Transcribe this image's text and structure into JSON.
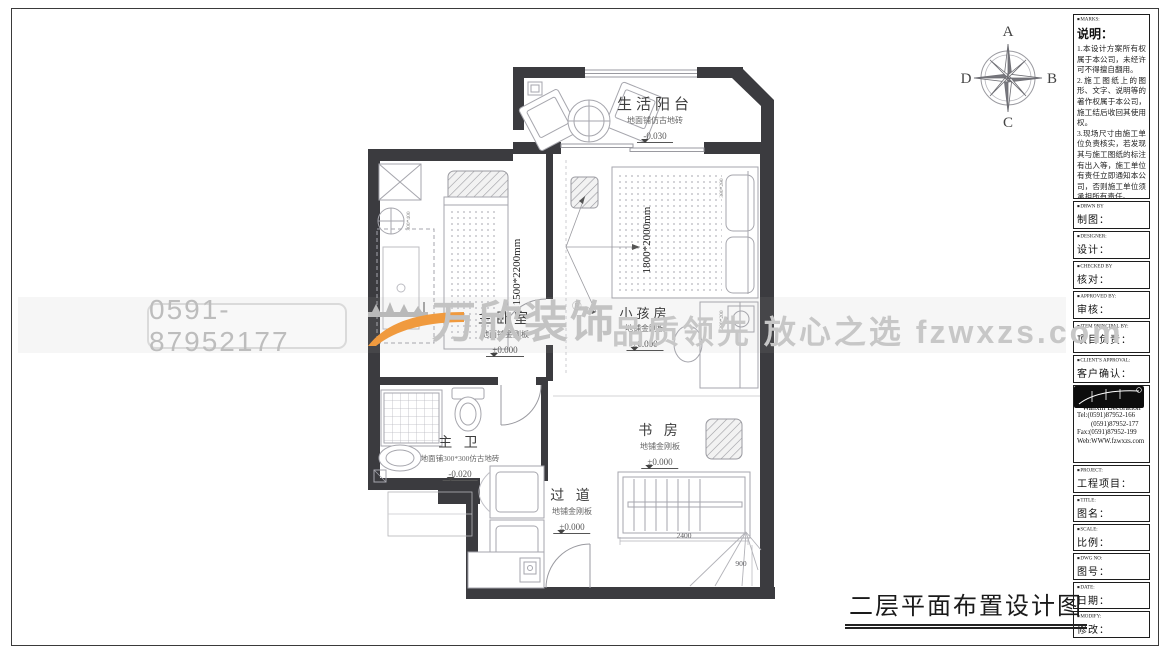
{
  "sheet": {
    "drawing_title": "二层平面布置设计图"
  },
  "compass": {
    "n": "A",
    "e": "B",
    "s": "C",
    "w": "D"
  },
  "watermark": {
    "phone": "0591-87952177",
    "brand": "万欣装饰",
    "reg": "®",
    "slogan": "品质领先 放心之选 fzwxzs.com"
  },
  "plan": {
    "rooms": {
      "balcony": {
        "name": "生活阳台",
        "floor": "地面铺仿古地砖",
        "level": "-0.030"
      },
      "master": {
        "name": "主卧室",
        "floor": "地面铺金刚板",
        "level": "±0.000",
        "bed": "1500*2200mm"
      },
      "kids": {
        "name": "小孩房",
        "floor": "地铺金刚板",
        "level": "±0.000",
        "bed": "1800*2000mm"
      },
      "bath": {
        "name": "主 卫",
        "floor": "地面铺300*300仿古地砖",
        "level": "-0.020"
      },
      "study": {
        "name": "书 房",
        "floor": "地铺金刚板",
        "level": "±0.000"
      },
      "corridor": {
        "name": "过 道",
        "floor": "地铺金刚板",
        "level": "±0.000"
      }
    },
    "dims": {
      "stair_width": "2400",
      "stair_depth": "900",
      "fan": "300*400",
      "niche_top": "300*200",
      "niche_bottom": "300*200"
    }
  },
  "titleblock": {
    "marks": {
      "en": "MARKS:",
      "zh": "说明：",
      "notes": [
        "1.本设计方案所有权属于本公司，未经许可不得擅自翻用。",
        "2.施工图纸上的图形、文字、说明等的著作权属于本公司，施工结后收回其使用权。",
        "3.现场尺寸由施工单位负责核实，若发现其与施工图纸的标注有出入等，施工单位有责任立即通知本公司，否则施工单位须承担所有责任。",
        "4.本设计方案是依客户要求设计，经客户签字即视为同意认可，不得随意更改。"
      ]
    },
    "drawn": {
      "en": "DRWN BY",
      "zh": "制图："
    },
    "designer": {
      "en": "DESIGNER:",
      "zh": "设计："
    },
    "checked": {
      "en": "CHECKED BY",
      "zh": "核对："
    },
    "approved": {
      "en": "APPROVED BY:",
      "zh": "审核："
    },
    "principal": {
      "en": "ITEM PRINCIPAL BY:",
      "zh": "项目负责："
    },
    "client": {
      "en": "CLIENT'S APPROVAL:",
      "zh": "客户确认："
    },
    "company": {
      "cn": "万欣装饰",
      "en": "Wanxin Decoration",
      "tel1": "Tel:(0591)87952-166",
      "tel2": "(0591)87952-177",
      "fax": "Fax:(0591)87952-199",
      "web": "Web:WWW.fzwxzs.com"
    },
    "project": {
      "en": "PROJECT:",
      "zh": "工程项目："
    },
    "title": {
      "en": "TITLE:",
      "zh": "图名："
    },
    "scale": {
      "en": "SCALE:",
      "zh": "比例："
    },
    "dwg": {
      "en": "DWG NO:",
      "zh": "图号："
    },
    "date": {
      "en": "DATE:",
      "zh": "日期："
    },
    "modify": {
      "en": "MODIFY:",
      "zh": "修改："
    }
  }
}
